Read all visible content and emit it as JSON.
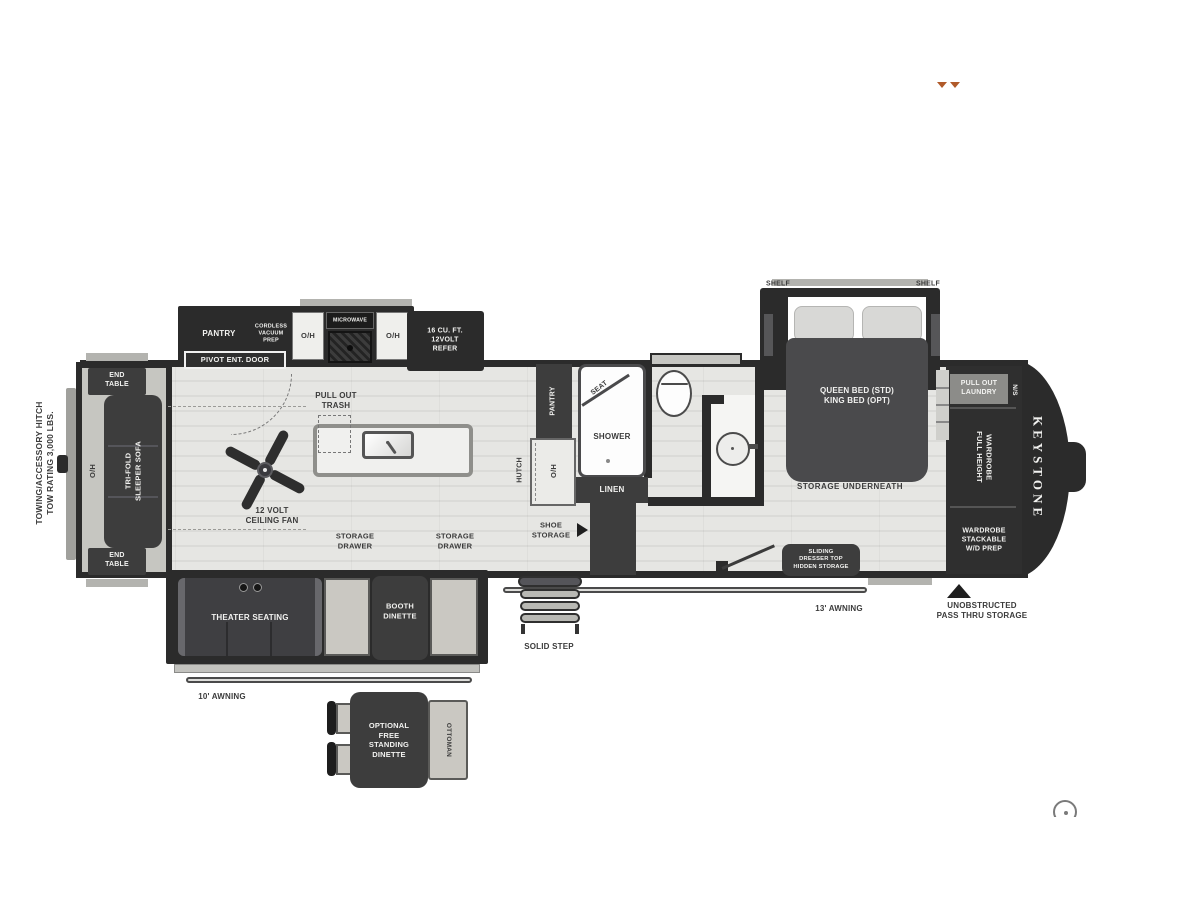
{
  "brand": {
    "name": "KEYSTONE"
  },
  "exterior": {
    "hitch_note": "TOWING/ACCESSORY HITCH\nTOW RATING 3,000 LBS.",
    "awning_rear": "10' AWNING",
    "awning_front": "13' AWNING",
    "solid_step": "SOLID STEP",
    "pass_thru": "UNOBSTRUCTED\nPASS THRU STORAGE"
  },
  "living": {
    "end_table_top": "END\nTABLE",
    "end_table_bottom": "END\nTABLE",
    "sofa": "TRI-FOLD\nSLEEPER SOFA",
    "overhead": "O/H",
    "theater": "THEATER SEATING",
    "booth": "BOOTH\nDINETTE",
    "fan": "12 VOLT\nCEILING FAN",
    "storage_drawer_left": "STORAGE\nDRAWER",
    "storage_drawer_right": "STORAGE\nDRAWER"
  },
  "kitchen": {
    "pantry": "PANTRY",
    "vacuum_prep": "CORDLESS\nVACUUM\nPREP",
    "overhead_left": "O/H",
    "microwave": "MICROWAVE",
    "overhead_right": "O/H",
    "refrigerator": "16 CU. FT.\n12VOLT\nREFER",
    "entry_door": "PIVOT ENT. DOOR",
    "pull_out_trash": "PULL OUT\nTRASH"
  },
  "hall": {
    "hutch": "HUTCH",
    "pantry": "PANTRY",
    "overhead": "O/H",
    "shoe_storage": "SHOE\nSTORAGE"
  },
  "bath": {
    "seat": "SEAT",
    "shower": "SHOWER",
    "linen": "LINEN"
  },
  "bedroom": {
    "shelf_left": "SHELF",
    "shelf_right": "SHELF",
    "bed": "QUEEN BED (STD)\nKING BED (OPT)",
    "under_bed": "STORAGE UNDERNEATH",
    "dresser": "SLIDING\nDRESSER TOP\nHIDDEN STORAGE",
    "laundry": "PULL OUT\nLAUNDRY",
    "nightstand": "N/S",
    "wardrobe_full": "FULL HEIGHT\nWARDROBE",
    "wardrobe_wd": "WARDROBE\nSTACKABLE\nW/D PREP"
  },
  "optional": {
    "dinette": "OPTIONAL\nFREE\nSTANDING\nDINETTE",
    "ottoman": "OTTOMAN"
  },
  "colors": {
    "wall": "#2b2b2b",
    "furniture": "#3d3d3d",
    "accent_arrows": "#b05a2a"
  }
}
